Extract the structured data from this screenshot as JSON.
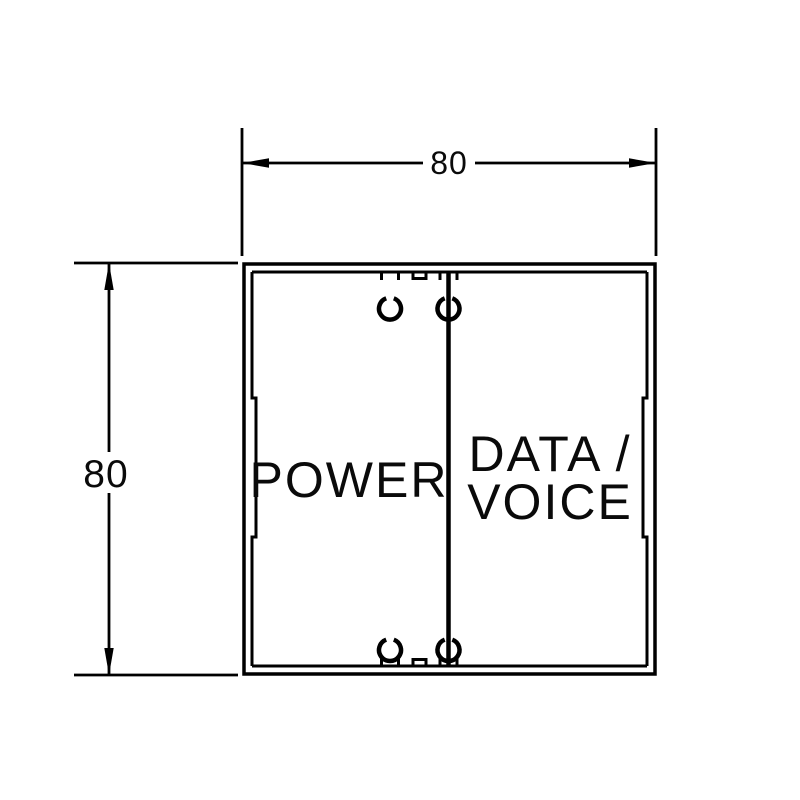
{
  "dimensions": {
    "width_value": "80",
    "height_value": "80"
  },
  "labels": {
    "left_compartment": "POWER",
    "right_compartment_line1": "DATA /",
    "right_compartment_line2": "VOICE"
  },
  "colors": {
    "ink": "#000000",
    "background": "#ffffff"
  }
}
